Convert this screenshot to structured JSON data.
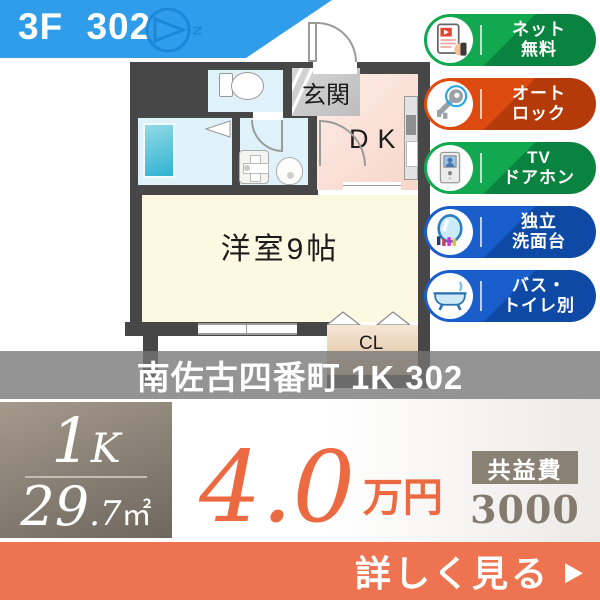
{
  "header": {
    "room_label": "3F 302",
    "compass_letter": "N"
  },
  "floorplan": {
    "entrance": "玄関",
    "dk": "DK",
    "main_room": "洋室9帖",
    "closet": "CL"
  },
  "badges": [
    {
      "line1": "ネット",
      "line2": "無料",
      "icon": "internet-icon",
      "color": "#12a850"
    },
    {
      "line1": "オート",
      "line2": "ロック",
      "icon": "key-icon",
      "color": "#dd4a10"
    },
    {
      "line1": "TV",
      "line2": "ドアホン",
      "icon": "doorphone-icon",
      "color": "#12a850"
    },
    {
      "line1": "独立",
      "line2": "洗面台",
      "icon": "washstand-icon",
      "color": "#1a5ecb"
    },
    {
      "line1": "バス・",
      "line2": "トイレ別",
      "icon": "bathtub-icon",
      "color": "#1a5ecb"
    }
  ],
  "title_bar": {
    "text": "南佐古四番町 1K 302"
  },
  "summary": {
    "layout_main": "1",
    "layout_sub": "K",
    "area_main": "29",
    "area_sub": ".7",
    "area_unit": "㎡",
    "rent_value": "4.0",
    "rent_unit": "万円",
    "fee_label": "共益費",
    "fee_value": "3000円"
  },
  "footer": {
    "cta": "詳しく見る",
    "arrow": "▶"
  },
  "colors": {
    "header_blue": "#2f9de9",
    "footer_orange": "#ee7350",
    "price_orange": "#ec6a42",
    "taupe_box": "#8a8175",
    "wall_gray": "#474747"
  }
}
